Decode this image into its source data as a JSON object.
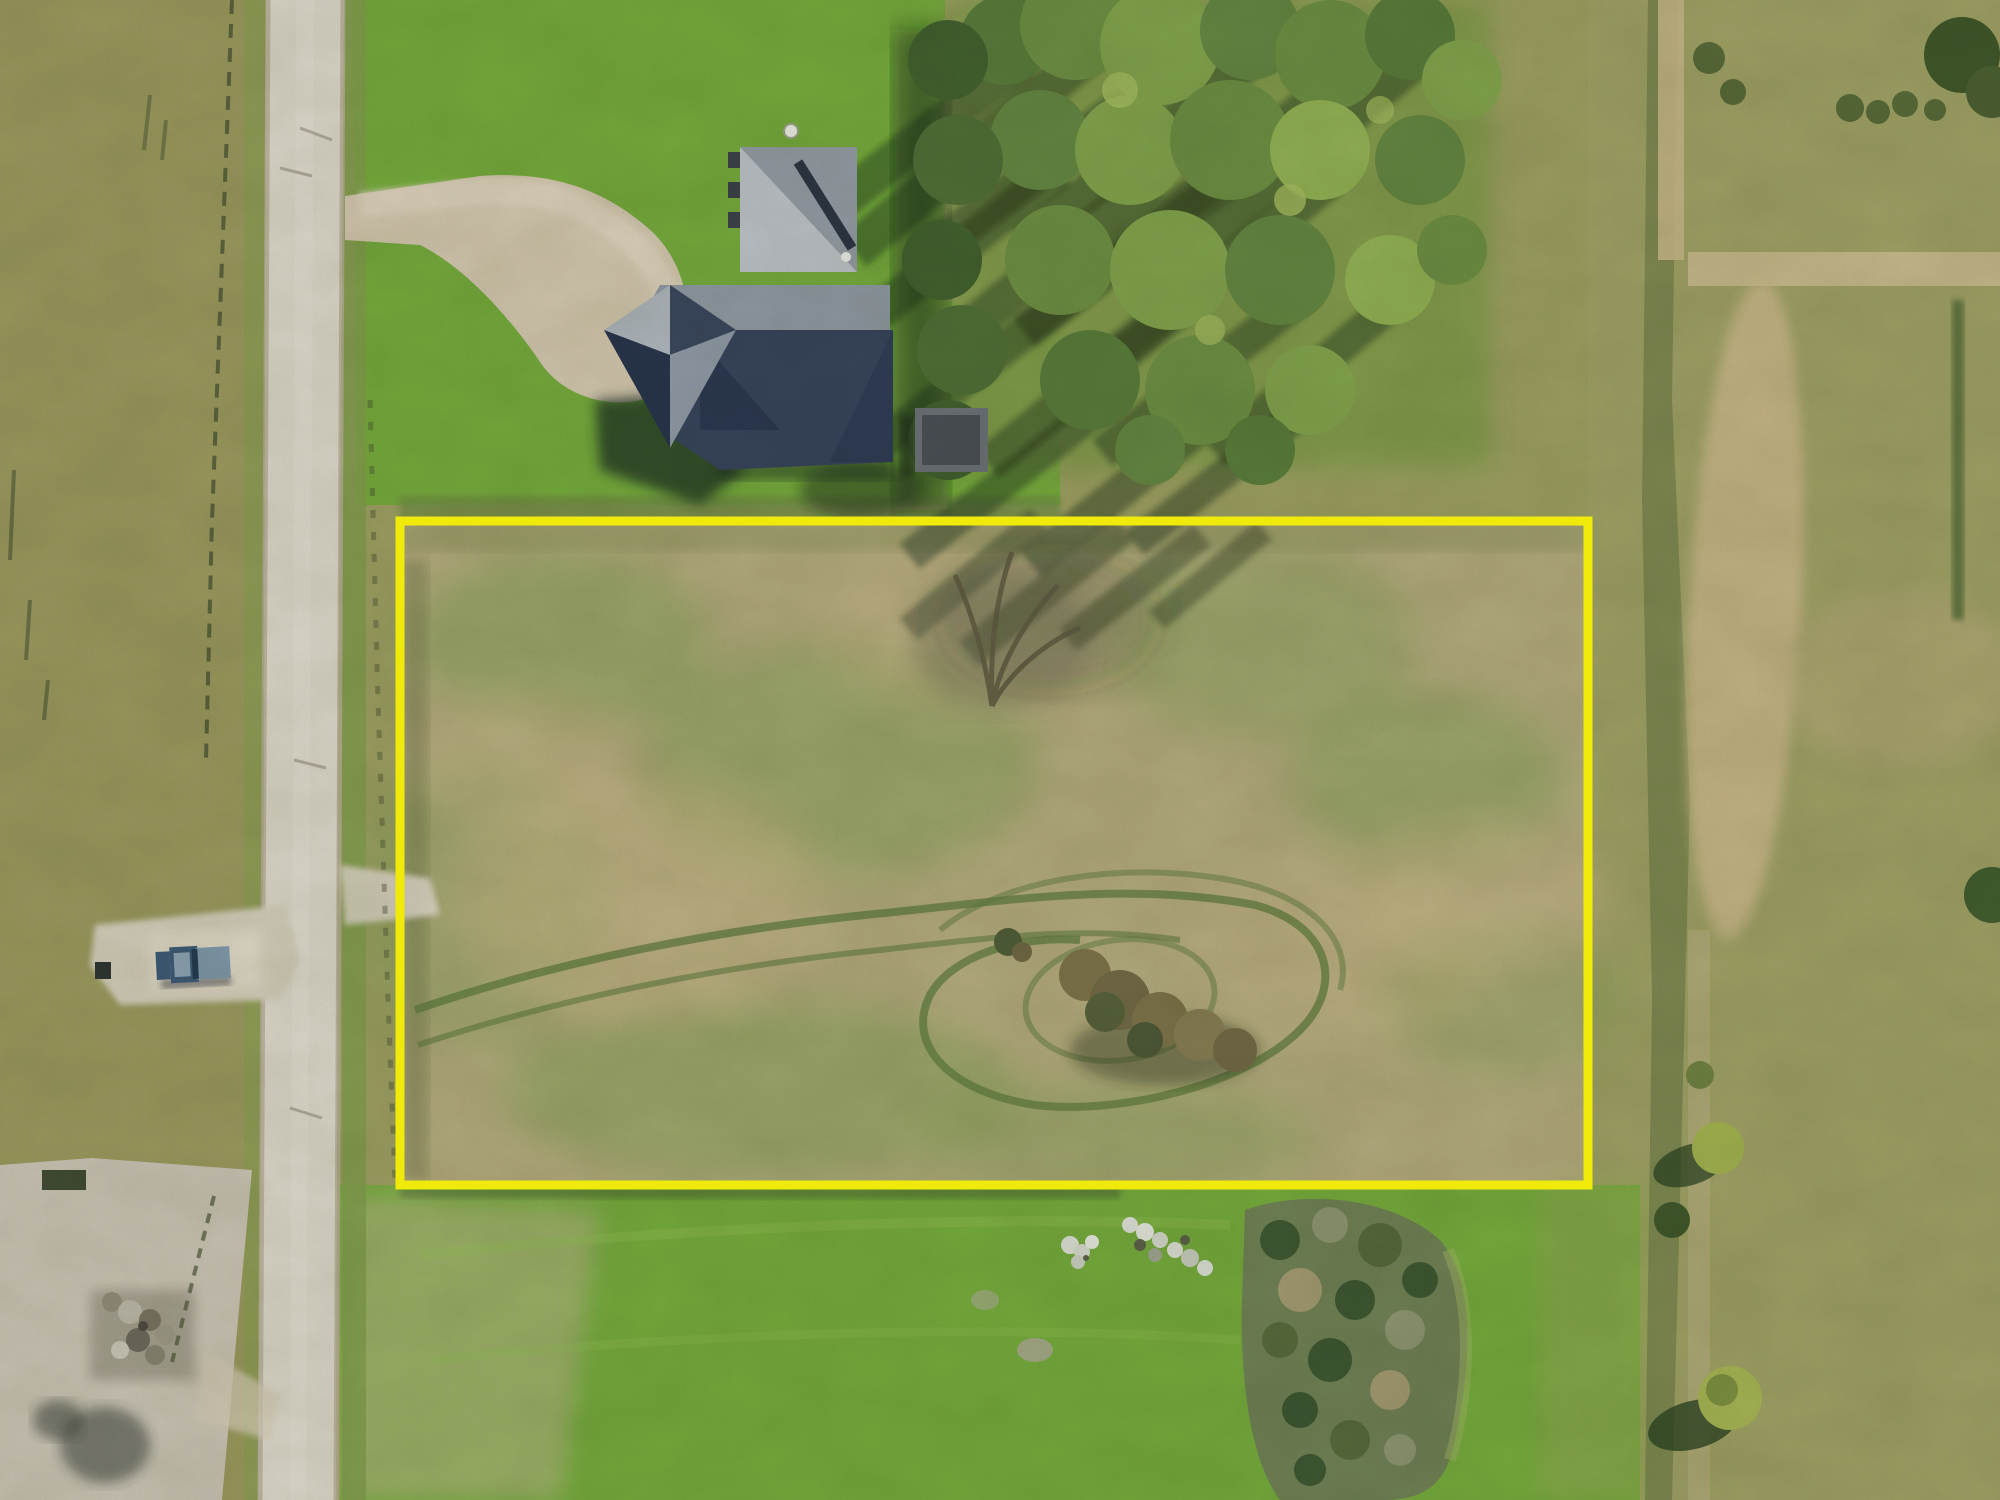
{
  "meta": {
    "image_type": "aerial-drone-photo",
    "subject": "vacant rural land lot outlined in yellow next to a house and road",
    "view": "top-down"
  },
  "canvas": {
    "width": 2000,
    "height": 1500
  },
  "palette": {
    "field_base": "#9a9c60",
    "field_left": "#97965c",
    "field_right": "#9c9e63",
    "lot_fill": "#b1a87c",
    "lot_green_patch": "#7f9b53",
    "lawn_green": "#73a73b",
    "road_gray": "#d7d3c7",
    "road_shoulder": "#b3ab95",
    "driveway_gravel": "#cfc3ac",
    "boundary_yellow": "#f0ea0a",
    "roof_light": "#b9bec5",
    "roof_mid": "#9199a3",
    "roof_dark": "#36435a",
    "shadow_dark": "#1d2d22",
    "tree_green_dark": "#415f2e",
    "tree_green": "#6b8c42",
    "tree_green_light": "#8fae52",
    "truck_blue": "#3d5a77",
    "truck_bed": "#7e97ab",
    "dirt_pad": "#c6c0b2",
    "ditch_tan": "#c4b286",
    "rock_white": "#d8dbd2",
    "brush_dark": "#3c5531"
  },
  "objects": {
    "property_boundary": {
      "label": "yellow property outline",
      "x": 400,
      "y": 521,
      "width": 1188,
      "height": 664
    },
    "road": {
      "label": "paved country road, left side, running vertically"
    },
    "house": {
      "label": "gray hip-roof house at top center with gravel driveway"
    },
    "driveway": {
      "label": "gravel driveway from road to house"
    },
    "truck": {
      "label": "blue pickup truck parked on gravel pad left of road"
    },
    "trailer": {
      "label": "small utility trailer right of house"
    },
    "tree_grove": {
      "label": "tree grove with long diagonal shadows, top right of house"
    },
    "tire_tracks": {
      "label": "curved vehicle tracks looping inside the lot"
    },
    "shrub_cluster": {
      "label": "brown shrub cluster inside lower lot"
    },
    "rock_piles": {
      "label": "white rock piles on lawn below lot"
    },
    "brush_mound": {
      "label": "large brush/tree mound on lawn below lot"
    },
    "dirt_yard": {
      "label": "dirt farmyard with debris pile, bottom left"
    },
    "ditch_track": {
      "label": "tan dirt track / ditch line on right side"
    }
  }
}
